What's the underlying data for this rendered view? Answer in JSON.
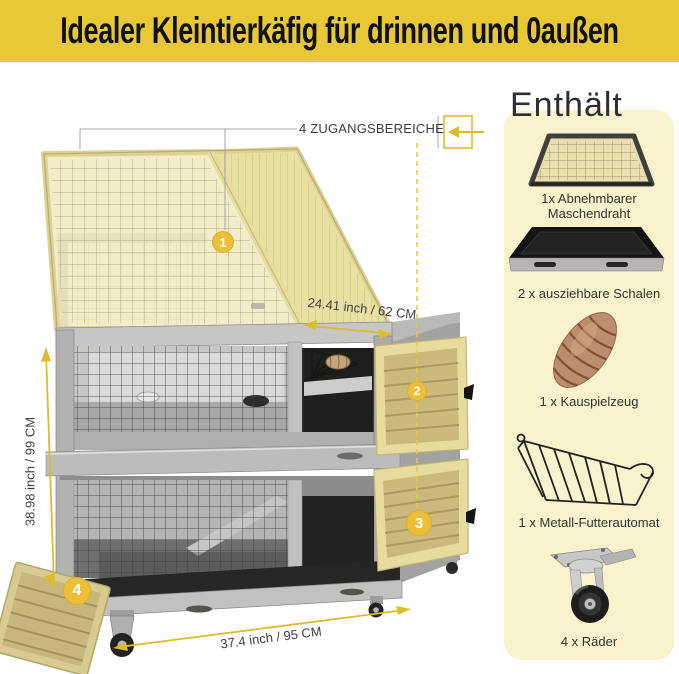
{
  "banner": {
    "title": "Idealer Kleintierkäfig für drinnen und 0außen"
  },
  "annotations": {
    "access_label": "4 ZUGANGSBEREICHE",
    "markers": [
      "1",
      "2",
      "3",
      "4"
    ],
    "dims": {
      "depth": "24.41 inch / 62 CM",
      "height": "38.98 inch / 99 CM",
      "width": "37.4 inch / 95 CM"
    }
  },
  "includes": {
    "heading": "Enthält",
    "items": [
      {
        "id": "mesh-screen",
        "lines": [
          "1x Abnehmbarer",
          "Maschendraht"
        ]
      },
      {
        "id": "pullout-trays",
        "lines": [
          "2 x ausziehbare Schalen"
        ]
      },
      {
        "id": "chew-toy",
        "lines": [
          "1 x Kauspielzeug"
        ]
      },
      {
        "id": "metal-feeder",
        "lines": [
          "1 x Metall-Futterautomat"
        ]
      },
      {
        "id": "casters",
        "lines": [
          "4 x Räder"
        ]
      }
    ]
  },
  "colors": {
    "banner-bg": "#E9C838",
    "banner-text": "#111111",
    "accent": "#DEBB2E",
    "dash": "#E6C94E",
    "marker": "#ECBF36",
    "panel-bg": "#FAF2CD",
    "label": "#3F3F3F"
  }
}
